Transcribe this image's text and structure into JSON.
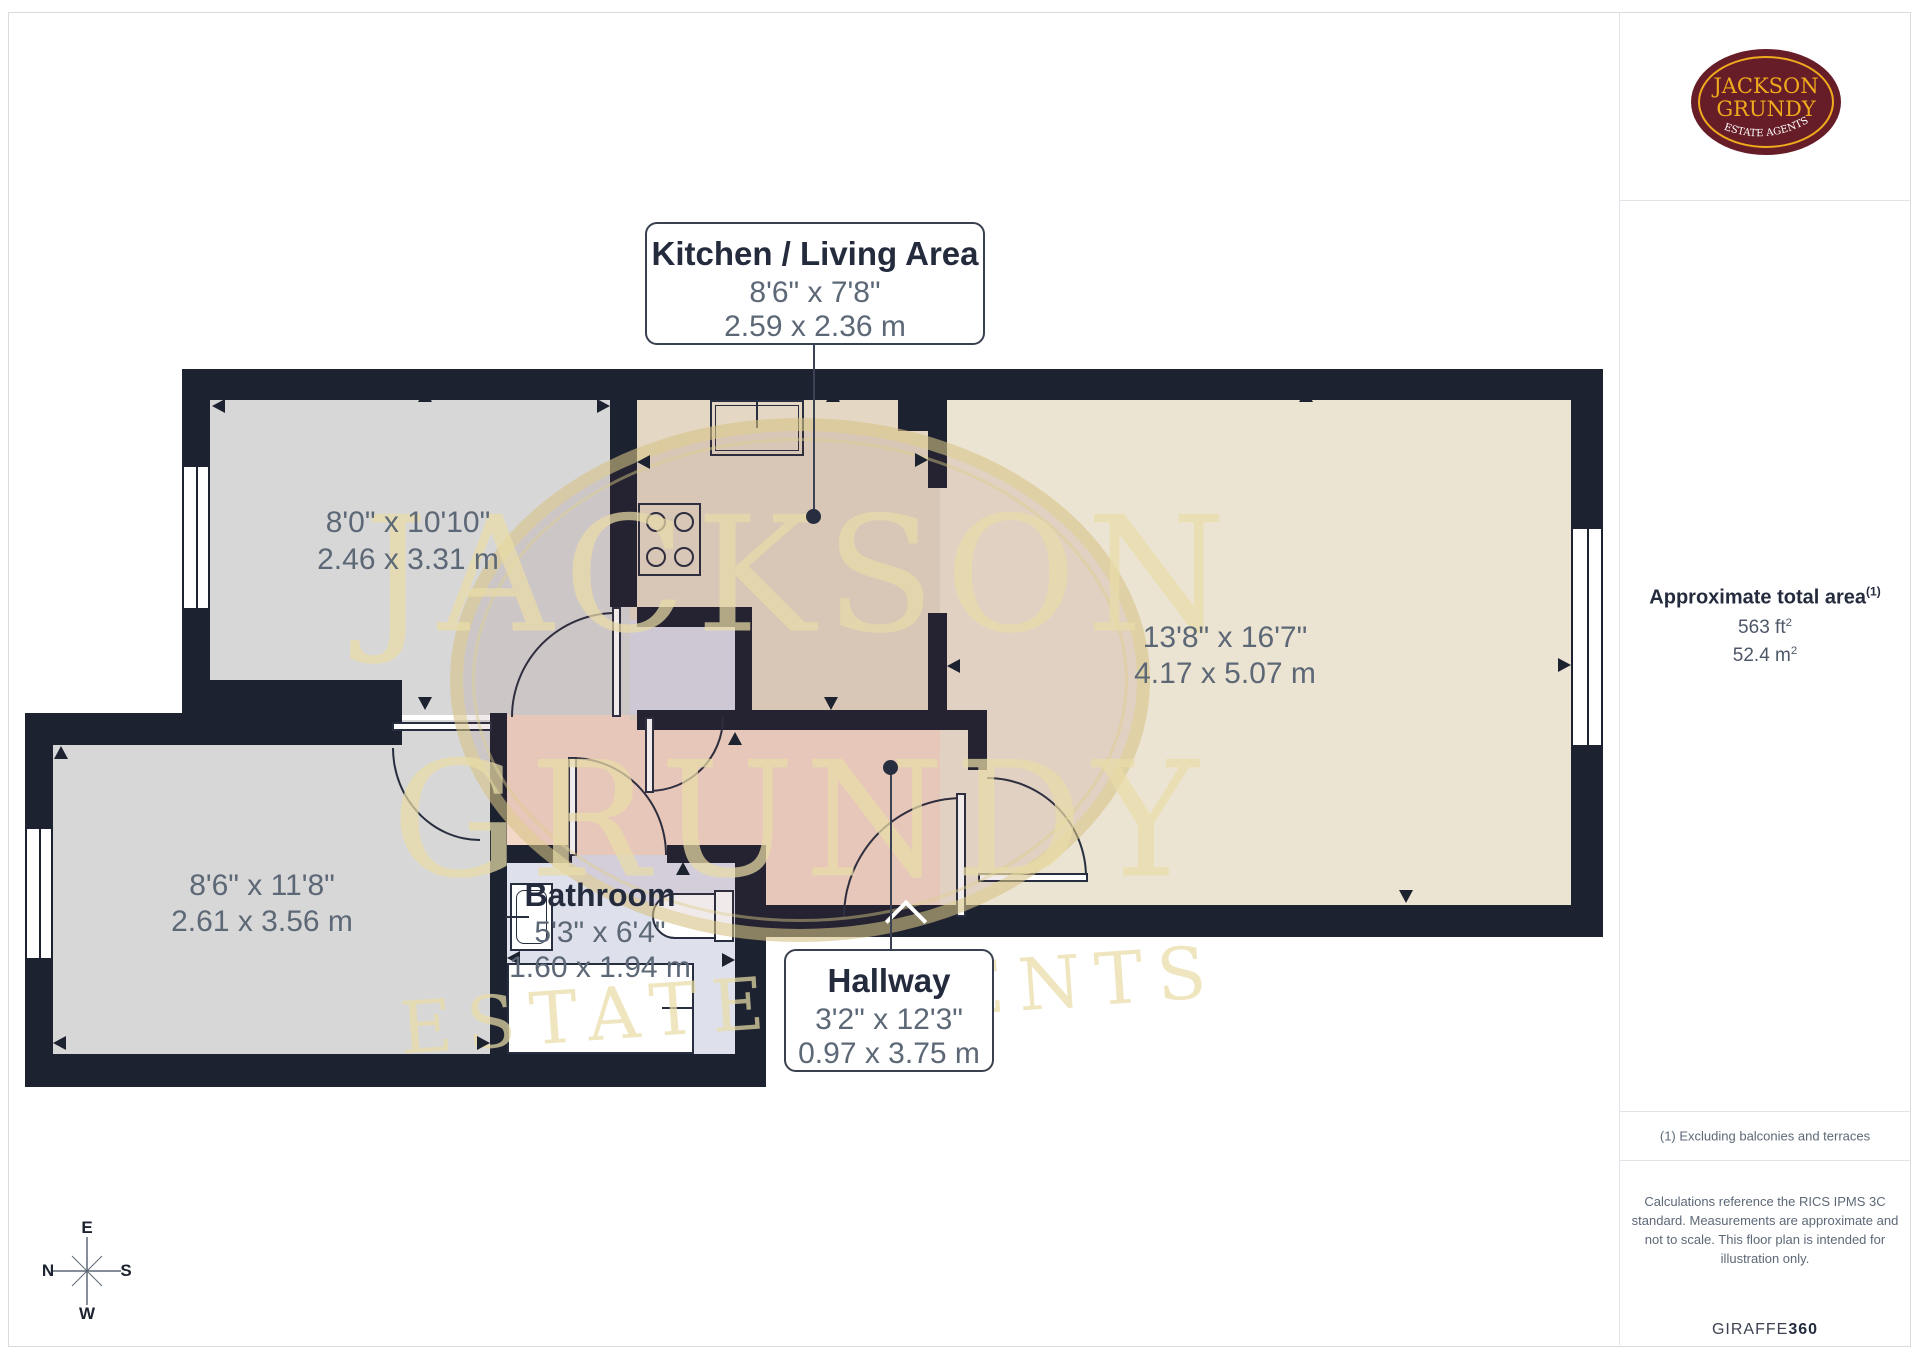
{
  "logo": {
    "line1": "JACKSON",
    "line2": "GRUNDY",
    "tagline": "ESTATE AGENTS",
    "bg_color": "#671d27",
    "gold_color": "#efaa1e"
  },
  "sidebar": {
    "area_title": "Approximate total area",
    "area_sup": "(1)",
    "imperial": "563 ft",
    "imperial_sup": "2",
    "metric": "52.4 m",
    "metric_sup": "2",
    "footnote": "(1) Excluding balconies and terraces",
    "disclaimer": "Calculations reference the RICS IPMS 3C standard. Measurements are approximate and not to scale. This floor plan is intended for illustration only.",
    "brand": "GIRAFFE",
    "brand_bold": "360"
  },
  "watermark": {
    "line1": "JACKSON",
    "line2": "GRUNDY",
    "tagline": "ESTATE AGENTS"
  },
  "compass": {
    "top": "E",
    "right": "S",
    "bottom": "W",
    "left": "N"
  },
  "rooms": {
    "kitchen_living": {
      "label": "Kitchen / Living Area",
      "dims_ft": "8'6\" x 7'8\"",
      "dims_m": "2.59 x 2.36 m"
    },
    "bedroom_top": {
      "dims_ft": "8'0\" x 10'10\"",
      "dims_m": "2.46 x 3.31 m"
    },
    "living_room": {
      "dims_ft": "13'8\" x 16'7\"",
      "dims_m": "4.17 x 5.07 m"
    },
    "bedroom_bottom": {
      "dims_ft": "8'6\" x 11'8\"",
      "dims_m": "2.61 x 3.56 m"
    },
    "bathroom": {
      "label": "Bathroom",
      "dims_ft": "5'3\" x 6'4\"",
      "dims_m": "1.60 x 1.94 m"
    },
    "hallway": {
      "label": "Hallway",
      "dims_ft": "3'2\" x 12'3\"",
      "dims_m": "0.97 x 3.75 m"
    }
  },
  "colors": {
    "wall": "#1c2230",
    "bedroom": "#d7d7d7",
    "kitchen": "#e4d8c5",
    "living": "#ece4d2",
    "bathroom": "#dee0eb",
    "closet": "#d9dae6",
    "hallway": "#f3d8c8"
  }
}
